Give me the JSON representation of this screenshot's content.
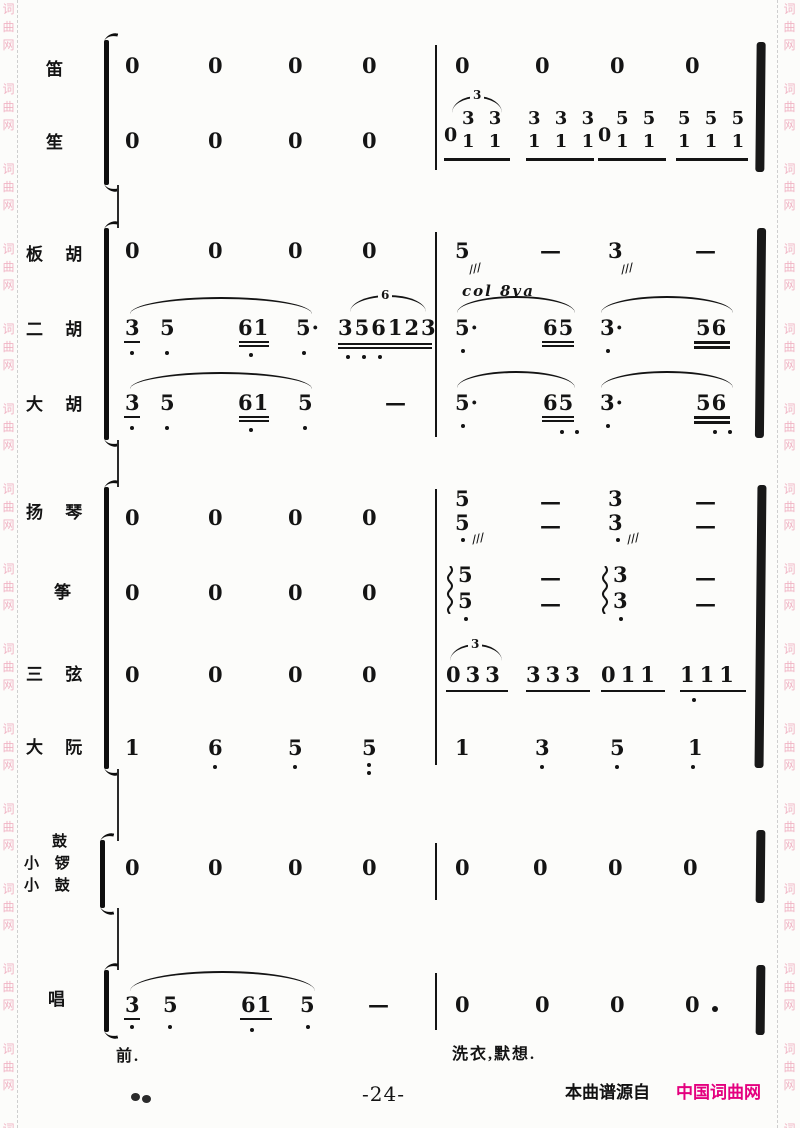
{
  "watermark": {
    "chars": [
      "词",
      "曲",
      "网"
    ],
    "color": "#f0b4c4"
  },
  "glyphs": {
    "rest": "0",
    "dash": "—",
    "tremolo": "///"
  },
  "footer": {
    "page_number": "-24-",
    "source_prefix": "本曲谱源自",
    "source_name": "中国词曲网",
    "source_color": "#e4007f"
  },
  "instruments": {
    "di": {
      "label": "笛"
    },
    "sheng": {
      "label": "笙",
      "g1": {
        "lead": "0",
        "top": "3 3",
        "bottom": "1 1",
        "tuplet": "3"
      },
      "g2": {
        "top": "3 3 3",
        "bottom": "1 1 1"
      },
      "g3": {
        "lead": "0",
        "top": "5 5",
        "bottom": "1 1"
      },
      "g4": {
        "top": "5 5 5",
        "bottom": "1 1 1"
      }
    },
    "banhu": {
      "label": "板 胡",
      "m2": [
        "5",
        "3"
      ],
      "col8va": "col 8va"
    },
    "erhu": {
      "label": "二 胡",
      "m1": [
        "3",
        "5",
        "61",
        "5·",
        "356123"
      ],
      "tuplet6": "6",
      "m2": [
        "5·",
        "65",
        "3·",
        "56"
      ]
    },
    "dahu": {
      "label": "大 胡",
      "m1": [
        "3",
        "5",
        "61",
        "5"
      ],
      "m2": [
        "5·",
        "65",
        "3·",
        "56"
      ]
    },
    "yangqin": {
      "label": "扬 琴",
      "m2": [
        "5",
        "3"
      ]
    },
    "zheng": {
      "label": "筝",
      "m2": [
        "5",
        "3"
      ]
    },
    "sanxian": {
      "label": "三 弦",
      "m2": [
        "033",
        "333",
        "011",
        "111"
      ],
      "tuplet3": "3"
    },
    "daruan": {
      "label": "大 阮",
      "m1": [
        "1",
        "6",
        "5",
        "5"
      ],
      "m2": [
        "1",
        "3",
        "5",
        "1"
      ]
    },
    "percussion": {
      "label_top": "鼓",
      "label_mid": "小 锣",
      "label_bottom": "小 鼓"
    },
    "vocal": {
      "label": "唱",
      "m1": [
        "3",
        "5",
        "61",
        "5"
      ],
      "lyric_left": "前.",
      "lyric_right": "洗衣,默想."
    }
  }
}
